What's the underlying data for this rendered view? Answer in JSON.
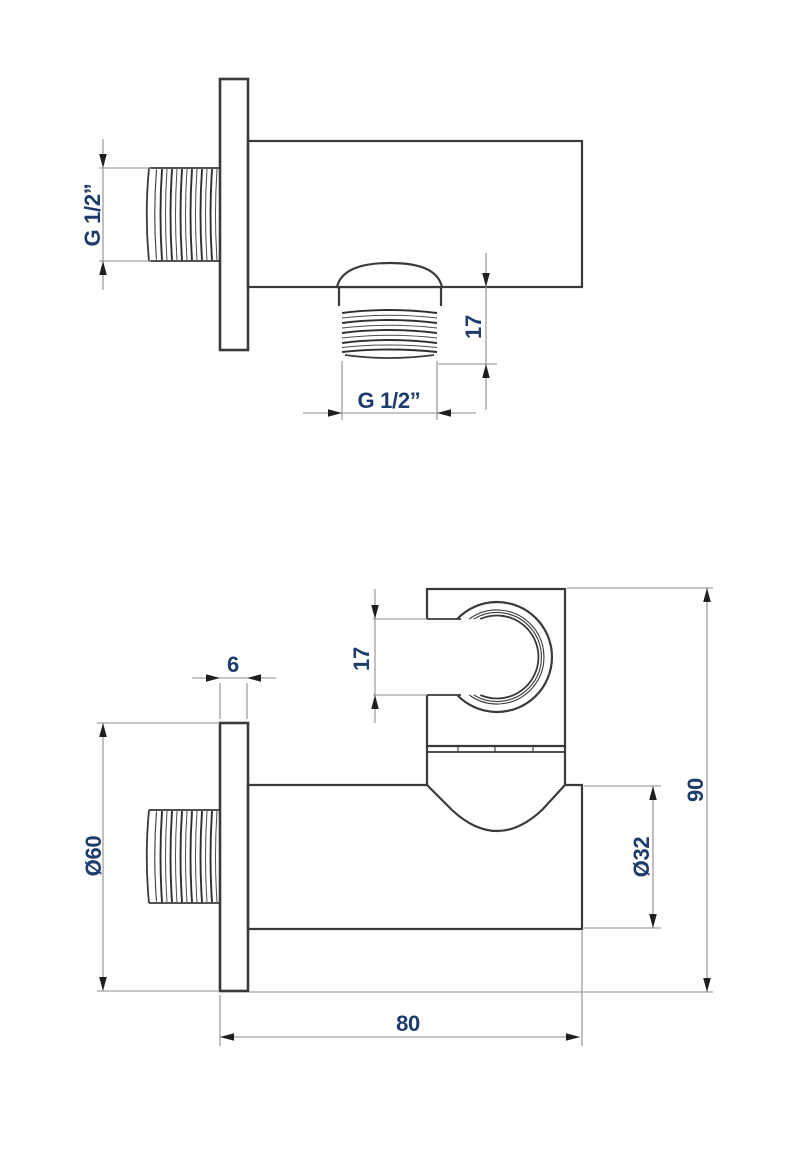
{
  "page": {
    "background": "#ffffff"
  },
  "colors": {
    "outline": "#3a3a3a",
    "dim_line": "#8e8e8e",
    "arrowhead": "#1f1f1f",
    "dim_text": "#1d3c6b"
  },
  "views": {
    "upper": {
      "dims": {
        "inlet_thread": "G 1/2”",
        "outlet_thread": "G 1/2”",
        "outlet_length": "17"
      }
    },
    "lower": {
      "dims": {
        "plate_thickness": "6",
        "clip_opening": "17",
        "plate_diameter": "Ø60",
        "body_diameter": "Ø32",
        "overall_height": "90",
        "overall_length": "80"
      }
    }
  }
}
